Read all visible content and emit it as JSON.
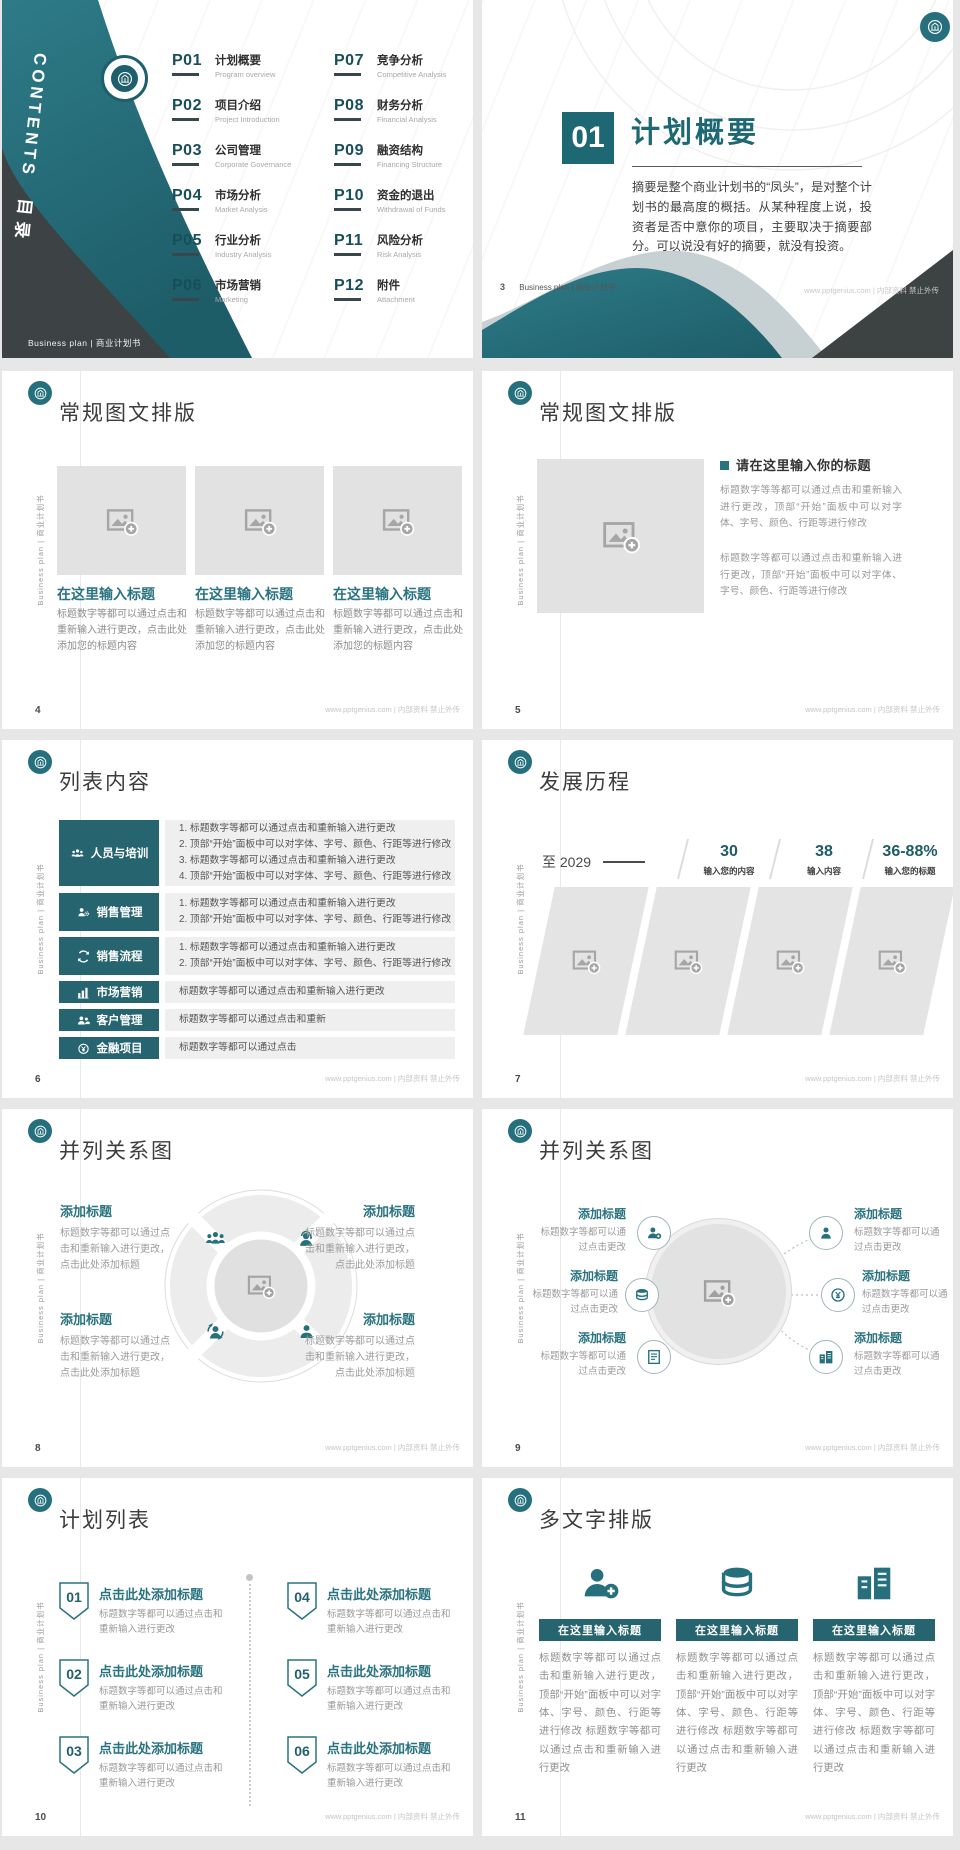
{
  "theme": {
    "accent_teal": "#26707d",
    "dark_slate": "#3d4345",
    "placeholder_gray": "#e2e2e2"
  },
  "footer": {
    "site": "www.pptgenius.com | 内部资料 禁止外传"
  },
  "common": {
    "brand_vertical": "Business plan | 商业计划书"
  },
  "toc": {
    "vertical_en": "CONTENTS",
    "vertical_cn": "目录",
    "footer": "Business plan | 商业计划书",
    "items": [
      {
        "num": "P01",
        "cn": "计划概要",
        "en": "Program overview"
      },
      {
        "num": "P02",
        "cn": "项目介绍",
        "en": "Project Introduction"
      },
      {
        "num": "P03",
        "cn": "公司管理",
        "en": "Corporate Governance"
      },
      {
        "num": "P04",
        "cn": "市场分析",
        "en": "Market Analysis"
      },
      {
        "num": "P05",
        "cn": "行业分析",
        "en": "Industry Analysis"
      },
      {
        "num": "P06",
        "cn": "市场营销",
        "en": "Marketing"
      },
      {
        "num": "P07",
        "cn": "竞争分析",
        "en": "Competitive Analysis"
      },
      {
        "num": "P08",
        "cn": "财务分析",
        "en": "Financial Analysis"
      },
      {
        "num": "P09",
        "cn": "融资结构",
        "en": "Financing Structure"
      },
      {
        "num": "P10",
        "cn": "资金的退出",
        "en": "Withdrawal of Funds"
      },
      {
        "num": "P11",
        "cn": "风险分析",
        "en": "Risk Analysis"
      },
      {
        "num": "P12",
        "cn": "附件",
        "en": "Attachment"
      }
    ]
  },
  "section": {
    "number": "01",
    "title": "计划概要",
    "body": "摘要是整个商业计划书的“凤头”，是对整个计划书的最高度的概括。从某种程度上说，投资者是否中意你的项目，主要取决于摘要部分。可以说没有好的摘要，就没有投资。",
    "page": "3",
    "footer_left": "Business plan | 商业计划书"
  },
  "gallery": {
    "title": "常规图文排版",
    "page": "4",
    "item_title": "在这里输入标题",
    "item_body": "标题数字等都可以通过点击和重新输入进行更改，点击此处添加您的标题内容"
  },
  "imagetext": {
    "title": "常规图文排版",
    "page": "5",
    "heading": "请在这里输入你的标题",
    "para1": "标题数字等等都可以通过点击和重新输入进行更改，顶部“开始”面板中可以对字体、字号、颜色、行距等进行修改",
    "para2": "标题数字等都可以通过点击和重新输入进行更改，顶部“开始”面板中可以对字体、字号、颜色、行距等进行修改"
  },
  "list": {
    "title": "列表内容",
    "page": "6",
    "rows": [
      {
        "icon": "team-icon",
        "label": "人员与培训",
        "lines": [
          "1.  标题数字等都可以通过点击和重新输入进行更改",
          "2.  顶部“开始”面板中可以对字体、字号、颜色、行距等进行修改",
          "3.  标题数字等都可以通过点击和重新输入进行更改",
          "4.  顶部“开始”面板中可以对字体、字号、颜色、行距等进行修改"
        ]
      },
      {
        "icon": "person-gear-icon",
        "label": "销售管理",
        "lines": [
          "1.  标题数字等都可以通过点击和重新输入进行更改",
          "2.  顶部“开始”面板中可以对字体、字号、颜色、行距等进行修改"
        ]
      },
      {
        "icon": "sync-arrows-icon",
        "label": "销售流程",
        "lines": [
          "1.  标题数字等都可以通过点击和重新输入进行更改",
          "2.  顶部“开始”面板中可以对字体、字号、颜色、行距等进行修改"
        ]
      },
      {
        "icon": "bar-chart-icon",
        "label": "市场营销",
        "lines": [
          "标题数字等都可以通过点击和重新输入进行更改"
        ]
      },
      {
        "icon": "customers-icon",
        "label": "客户管理",
        "lines": [
          "标题数字等都可以通过点击和重新"
        ]
      },
      {
        "icon": "finance-icon",
        "label": "金融项目",
        "lines": [
          "标题数字等都可以通过点击"
        ]
      }
    ]
  },
  "timeline": {
    "title": "发展历程",
    "page": "7",
    "year": "至 2029",
    "stats": [
      {
        "value": "30",
        "label": "输入您的内容"
      },
      {
        "value": "38",
        "label": "输入内容"
      },
      {
        "value": "36-88%",
        "label": "输入您的标题"
      }
    ]
  },
  "relation4": {
    "title": "并列关系图",
    "page": "8",
    "block_title": "添加标题",
    "block_body": "标题数字等都可以通过点击和重新输入进行更改，点击此处添加标题",
    "icons": [
      "team-icon",
      "support-person-icon",
      "person-sync-icon",
      "person-reading-icon"
    ]
  },
  "relation6": {
    "title": "并列关系图",
    "page": "9",
    "block_title": "添加标题",
    "block_body": "标题数字等都可以通过点击更改",
    "left_icons": [
      "person-add-icon",
      "coins-icon",
      "document-icon"
    ],
    "right_icons": [
      "person-icon",
      "money-icon",
      "building-icon"
    ]
  },
  "planlist": {
    "title": "计划列表",
    "page": "10",
    "numbers": [
      "01",
      "02",
      "03",
      "04",
      "05",
      "06"
    ],
    "item_title": "点击此处添加标题",
    "item_body": "标题数字等都可以通过点击和重新输入进行更改"
  },
  "multitext": {
    "title": "多文字排版",
    "page": "11",
    "col_header": "在这里输入标题",
    "col_body": "标题数字等都可以通过点击和重新输入进行更改，顶部“开始”面板中可以对字体、字号、颜色、行距等进行修改 标题数字等都可以通过点击和重新输入进行更改",
    "icons": [
      "person-add-icon",
      "coins-icon",
      "building-icon"
    ]
  }
}
